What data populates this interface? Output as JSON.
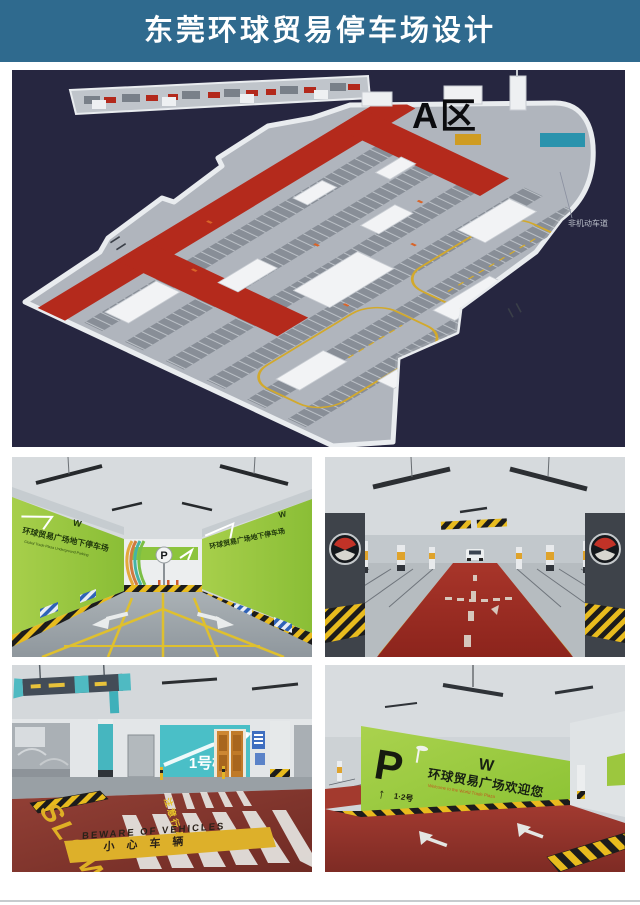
{
  "header": {
    "title": "东莞环球贸易停车场设计"
  },
  "plan": {
    "zone_label": "A区",
    "lane_label": "非机动车道"
  },
  "photos": {
    "entrance": {
      "wall_sign": "环球贸易广场地下停车场",
      "wall_sign_en": "Global Trade Plaza Underground Parking",
      "p_sign": "P"
    },
    "crosswalk": {
      "building_sign": "1号楼",
      "slow": "SLOW",
      "pedestrian": "注意行人",
      "warning_en": "BEWARE OF VEHICLES",
      "warning_cn": "小心车辆"
    },
    "welcome": {
      "p": "P",
      "arrow": "↑",
      "building": "1·2号",
      "welcome_cn": "环球贸易广场欢迎您",
      "welcome_en": "Welcome to the World Trade Plaza",
      "exit": "出口"
    }
  },
  "colors": {
    "header_teal": "#2f6a8e",
    "plan_background": "#262640",
    "road_red": "#b42a1c",
    "wall_green": "#96c93d",
    "hazard_yellow": "#e8bb1e",
    "accent_teal": "#4abfc7",
    "floor_red": "#8e3a31"
  }
}
